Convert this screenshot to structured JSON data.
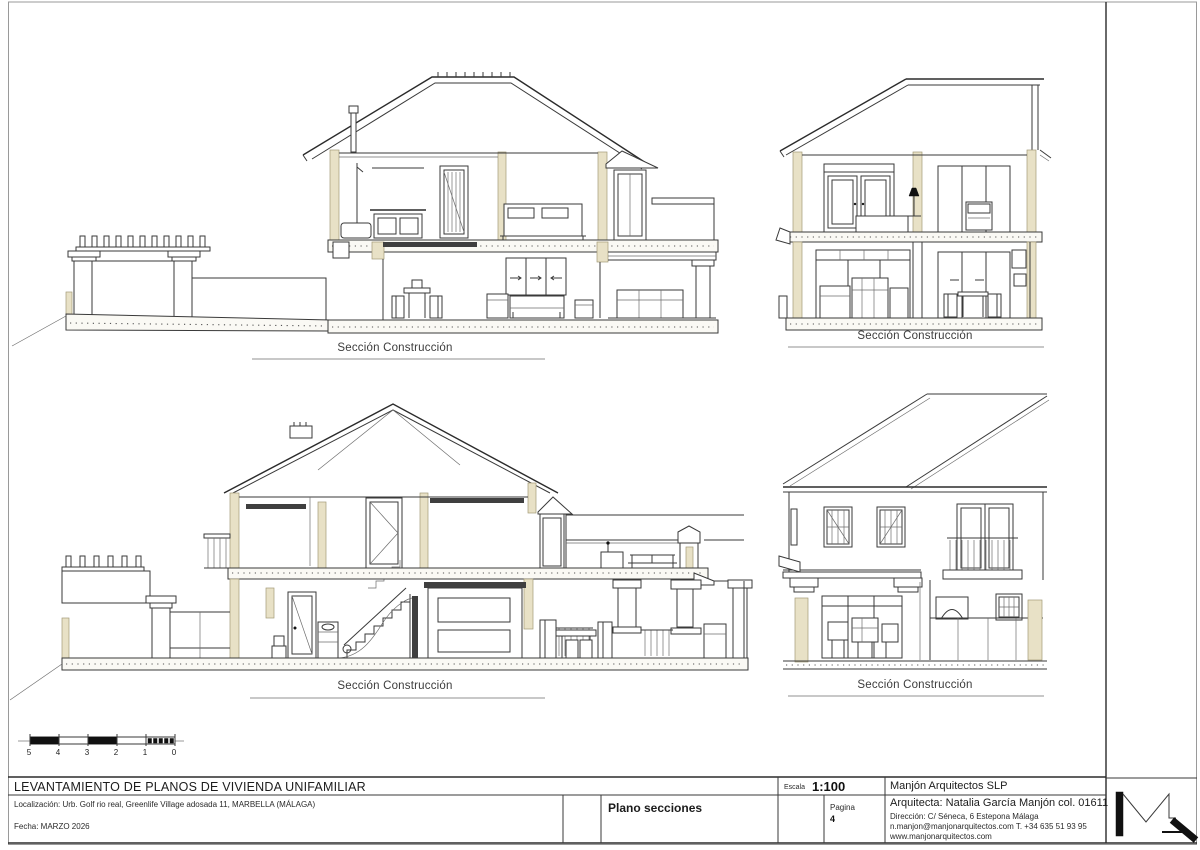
{
  "palette": {
    "paper": "#ffffff",
    "line": "#3a3a3a",
    "cut_wall_beige": "#e8e1c6",
    "border_gray": "#9a9a9a"
  },
  "drawings": [
    {
      "id": "section-top-left",
      "label": "Sección Construcción"
    },
    {
      "id": "section-top-right",
      "label": "Sección Construcción"
    },
    {
      "id": "section-bottom-left",
      "label": "Sección Construcción"
    },
    {
      "id": "section-bottom-right",
      "label": "Sección Construcción"
    }
  ],
  "scale_bar": {
    "labels": [
      "5",
      "4",
      "3",
      "2",
      "1",
      "0"
    ]
  },
  "title_block": {
    "project_title": "LEVANTAMIENTO DE PLANOS DE VIVIENDA UNIFAMILIAR",
    "location_line": "Localización:  Urb. Golf rio real, Greenlife Village adosada 11, MARBELLA (MÁLAGA)",
    "date_line": "Fecha: MARZO 2026",
    "sheet_name": "Plano secciones",
    "scale_label": "Escala",
    "scale_value": "1:100",
    "page_label": "Pagina",
    "page_number": "4",
    "firm_name": "Manjón Arquitectos SLP",
    "architect_line": "Arquitecta: Natalia García Manjón col. 01611",
    "address_line": "Dirección: C/ Séneca, 6 Estepona Málaga",
    "contact_line": "n.manjon@manjonarquitectos.com T. +34 635 51 93 95",
    "website_line": "www.manjonarquitectos.com"
  }
}
